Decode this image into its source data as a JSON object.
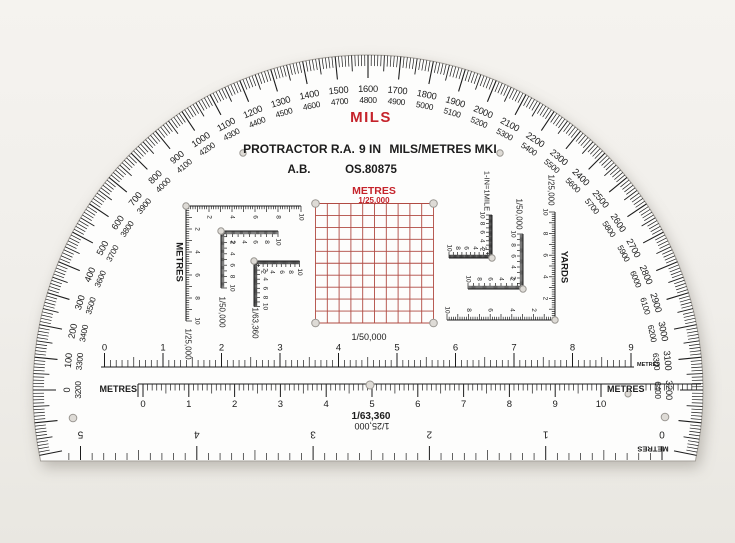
{
  "page": {
    "background": "#f0eeea"
  },
  "colors": {
    "red": "#c5232b",
    "ink": "#1c1c1c",
    "grid_red": "#b04a42",
    "plastic": "#fdfdfc",
    "edge": "#a6a29c",
    "hole_fill": "#dedbd6",
    "hole_ring": "#9a9792"
  },
  "title": {
    "mils": "MILS",
    "line1_left": "PROTRACTOR R.A.",
    "line1_mid": "9 IN",
    "line1_right": "MILS/METRES MKI",
    "line2_left": "A.B.",
    "line2_right": "OS.80875"
  },
  "arc": {
    "unit": "mils",
    "outer_start": 0,
    "outer_end": 3200,
    "label_step": 100,
    "minor_step": 10,
    "medium_step": 50,
    "inner_offset": 3200,
    "inner_start_label": "3200",
    "inner_end_label": "6400",
    "overrun_mils": 210
  },
  "grid": {
    "title": "METRES",
    "scale_label": "1/25,000",
    "rows": 10,
    "cols": 10
  },
  "corner_scales_left": [
    {
      "label": "1/25,000",
      "axis": "METRES",
      "max": 10,
      "numbers": [
        2,
        4,
        6,
        8,
        10
      ]
    },
    {
      "label": "1/50,000",
      "max": 10,
      "numbers": [
        2,
        4,
        6,
        8,
        10
      ]
    },
    {
      "label": "1/63,360",
      "max": 10,
      "numbers": [
        2,
        4,
        6,
        8,
        10
      ]
    }
  ],
  "corner_scales_right": [
    {
      "label": "1-IN=1MILE",
      "max": 10,
      "numbers": [
        2,
        4,
        6,
        8,
        10
      ]
    },
    {
      "label": "1/50,000",
      "max": 10,
      "numbers": [
        2,
        4,
        6,
        8,
        10
      ]
    },
    {
      "label": "1/25,000",
      "axis": "YARDS",
      "max": 10,
      "numbers": [
        2,
        4,
        6,
        8,
        10
      ]
    }
  ],
  "rulers": [
    {
      "name_label": "1/50,000",
      "end_label": "METRES",
      "numbers": [
        0,
        1,
        2,
        3,
        4,
        5,
        6,
        7,
        8,
        9
      ]
    },
    {
      "name_label": "1/63,360",
      "left_label": "METRES",
      "right_label": "METRES",
      "numbers": [
        0,
        1,
        2,
        3,
        4,
        5,
        6,
        7,
        8,
        9,
        10
      ]
    },
    {
      "name_label": "1/25,000",
      "end_label": "METRES",
      "numbers": [
        0,
        1,
        2,
        3,
        4,
        5
      ],
      "inverted": true
    }
  ]
}
